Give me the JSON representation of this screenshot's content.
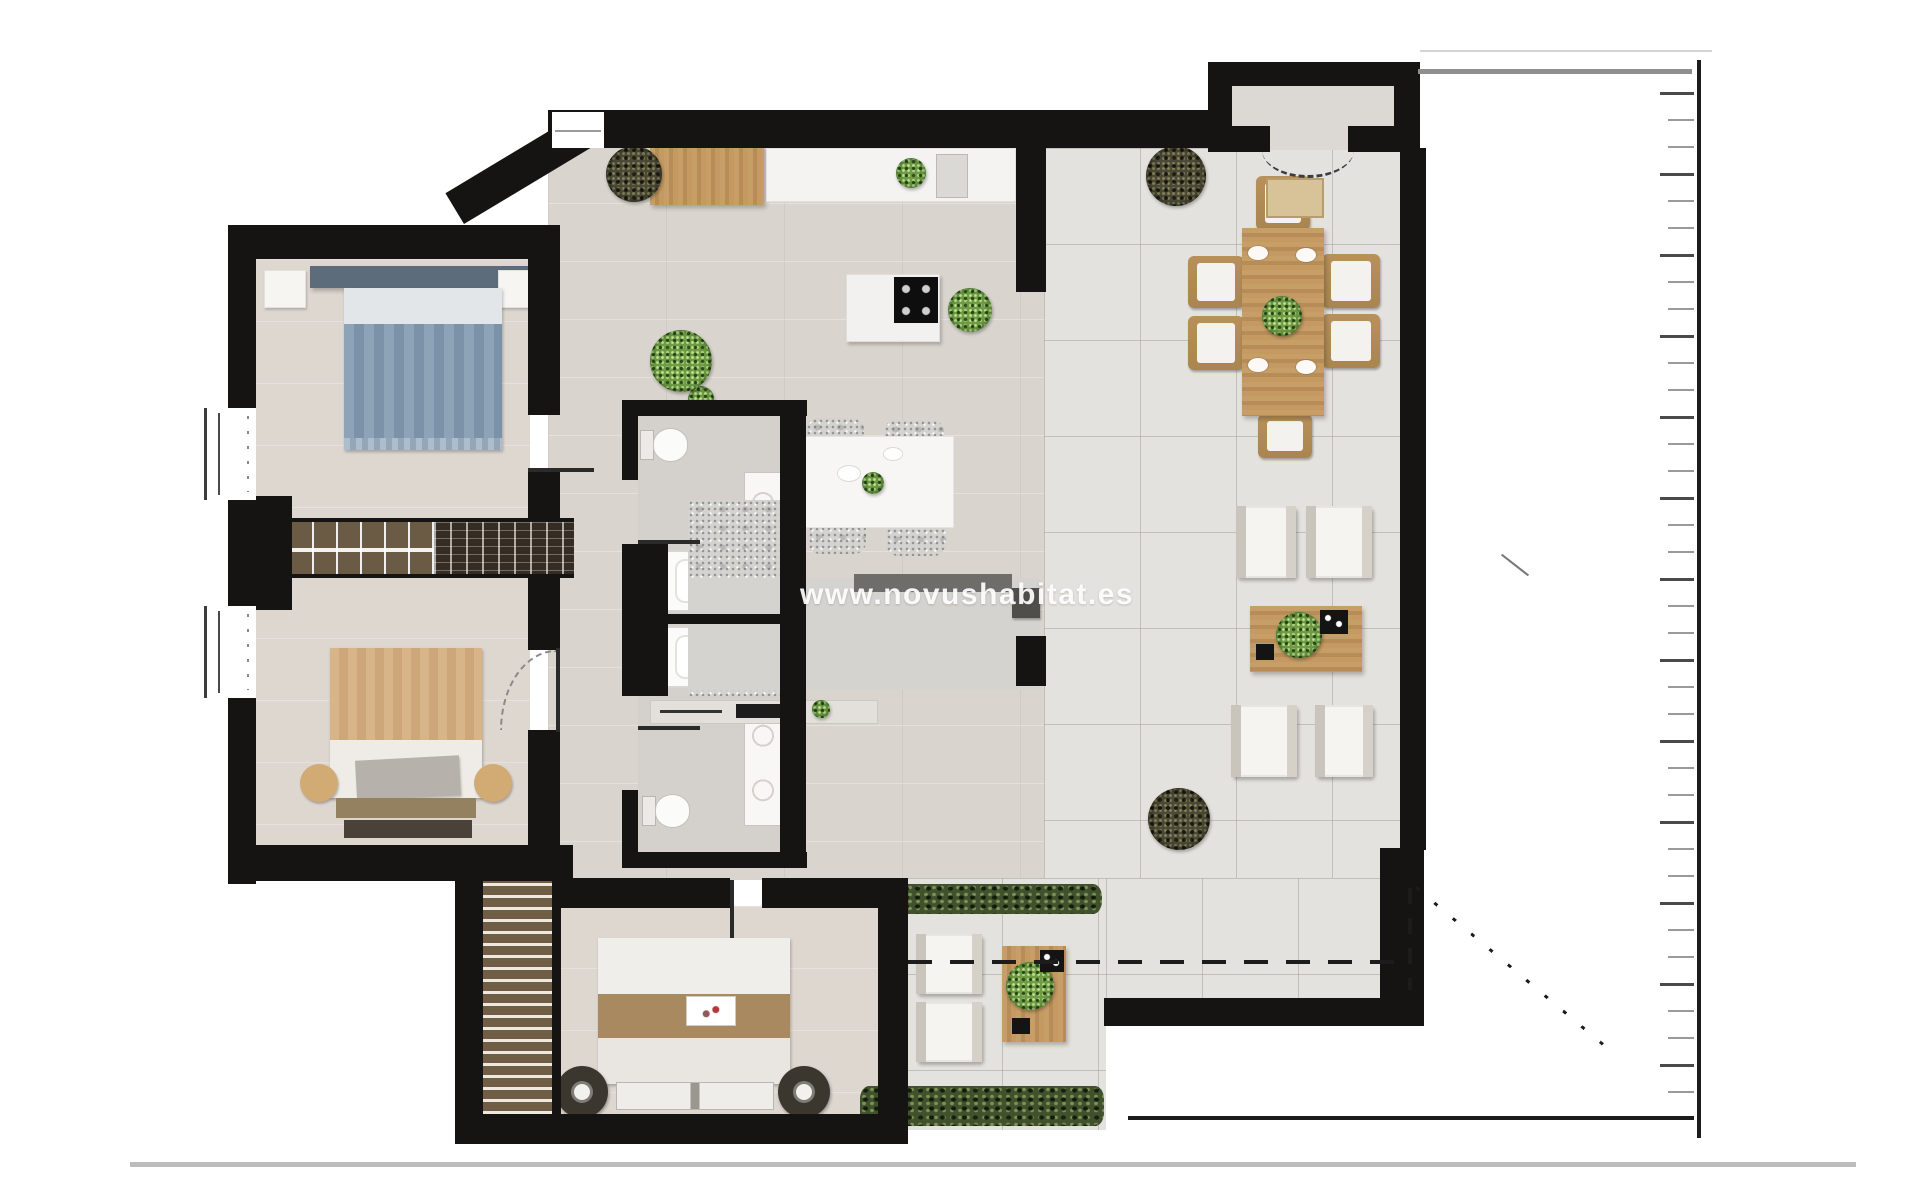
{
  "watermark": {
    "text": "www.novushabitat.es"
  },
  "colors": {
    "wall": "#161412",
    "floor_main": "#d9d4ce",
    "floor_bed": "#ded7d0",
    "floor_bath": "#d4d1cc",
    "floor_terrace": "#e4e2de",
    "floor_bump": "#dcd8d3",
    "speckle": "#d4d3cf",
    "white_furn": "#f6f5f2",
    "bed_blue": "#8da3b7",
    "bed_blue_dark": "#7b92a8",
    "bed_tan": "#d8b489",
    "bed_brown": "#a98a60",
    "hedge": "#41502d",
    "plant": "#6f9c45",
    "plant_dark": "#4c4a36",
    "annotation": "#1c1c1c",
    "gray_line": "#8f8f8f",
    "divider": "#bcbcbc",
    "tick": "#9a9a9a",
    "watermark": "rgba(255,255,255,0.92)"
  },
  "plan": {
    "type": "apartment-floor-plan",
    "rooms": [
      "bedroom-1",
      "bedroom-2",
      "master-bedroom",
      "bathroom-1",
      "bathroom-2",
      "kitchen-living-room",
      "dining-terrace",
      "lounge-terrace",
      "entrance-vestibule",
      "lower-terrace"
    ],
    "furniture": [
      "blue-double-bed",
      "tan-double-bed",
      "master-double-bed",
      "built-in-wardrobe",
      "stairs",
      "kitchen-counter",
      "kitchen-island-cooktop",
      "wood-sideboard",
      "dining-table-six-chairs",
      "small-table-four-chairs",
      "sectional-sofa",
      "tv-console",
      "lounge-armchairs",
      "coffee-table",
      "outdoor-armchairs",
      "outdoor-table",
      "bathtubs",
      "toilets",
      "vanities",
      "planters",
      "hedges",
      "doormat"
    ],
    "annotations": [
      "dimension-ruler-right",
      "top-boundary-lines",
      "bottom-divider-line",
      "terrace-dashed-line",
      "plot-dotted-diagonal",
      "door-swing-arcs"
    ]
  }
}
